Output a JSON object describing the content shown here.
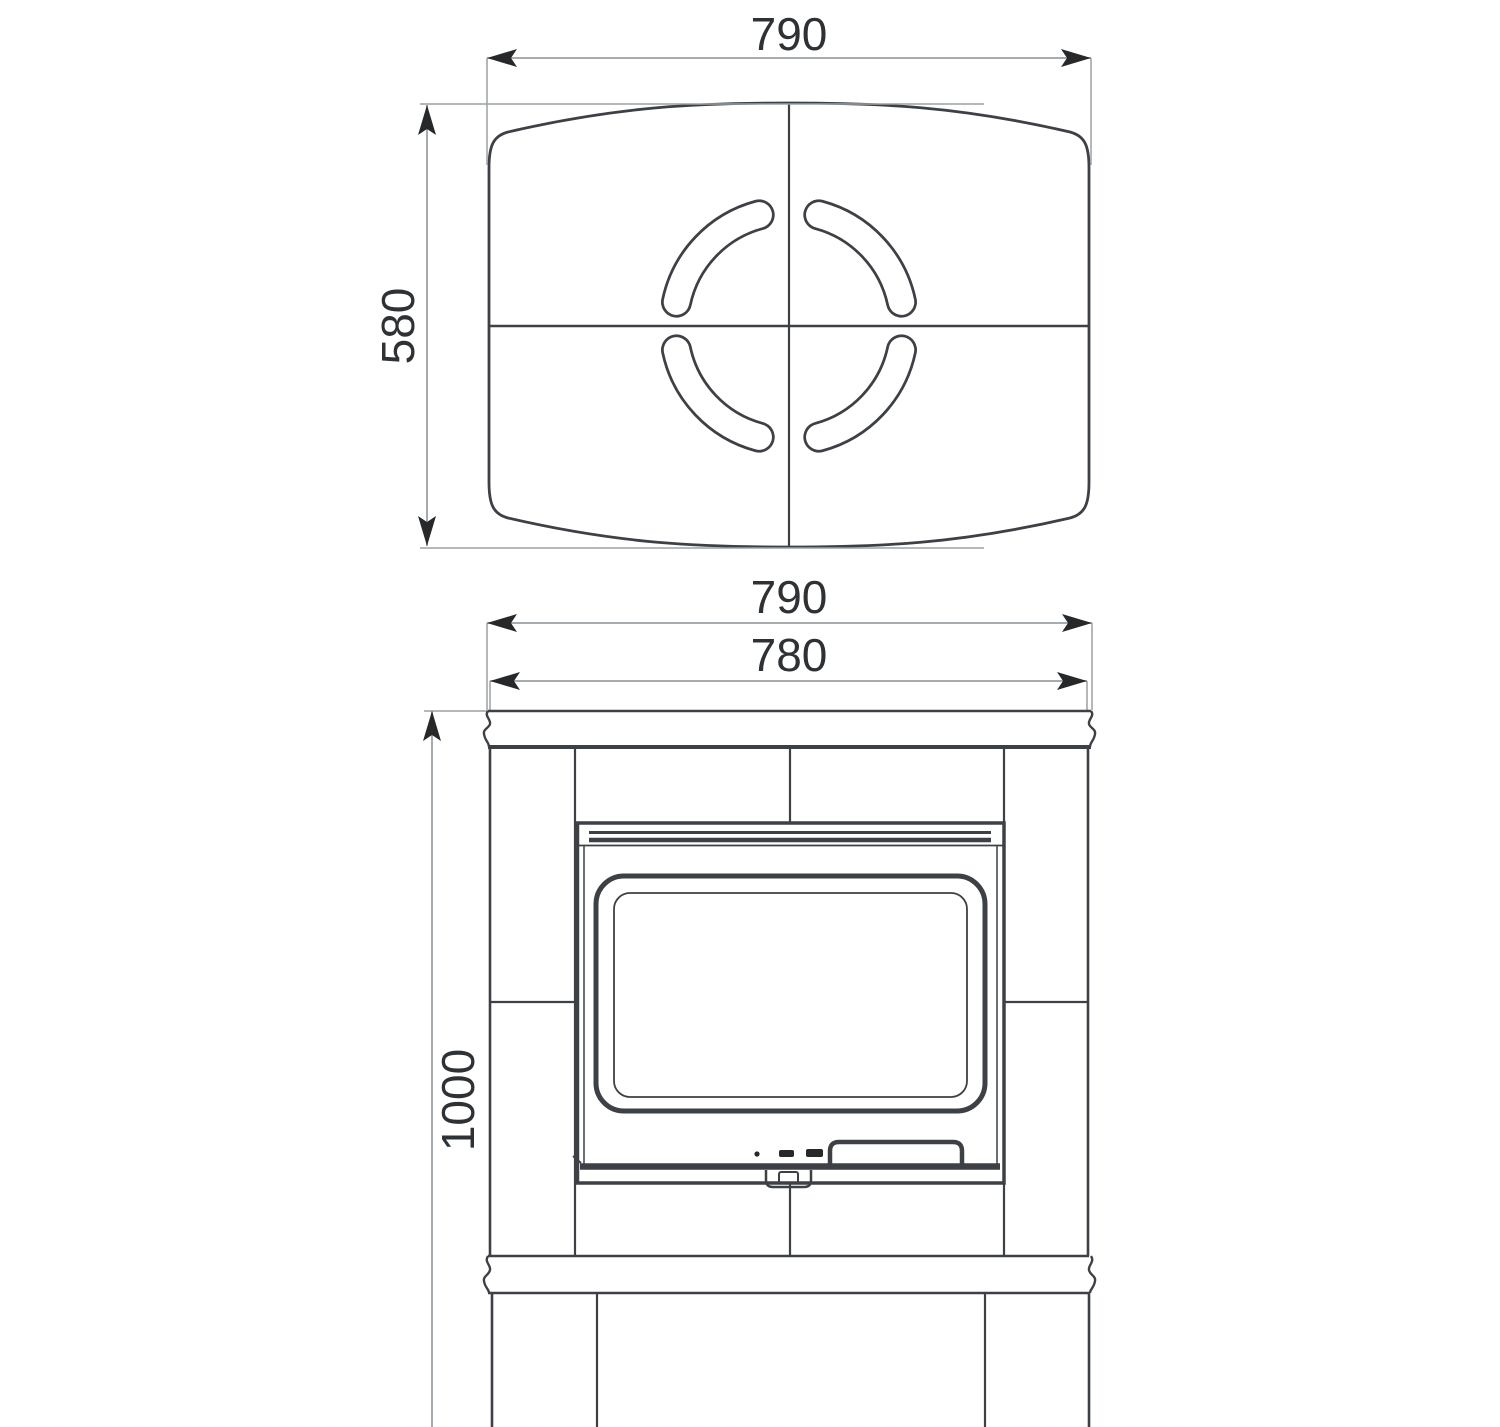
{
  "drawing": {
    "kind": "stove-technical-drawing",
    "labels": {
      "top_view_width": "790",
      "top_view_depth": "580",
      "front_overall_width": "790",
      "front_body_width": "780",
      "front_height": "1000"
    },
    "colors": {
      "ink": "#3d4145",
      "dim": "#9aa0a4",
      "arrow": "#26282a",
      "text": "#2f3235",
      "bg": "#ffffff"
    }
  }
}
